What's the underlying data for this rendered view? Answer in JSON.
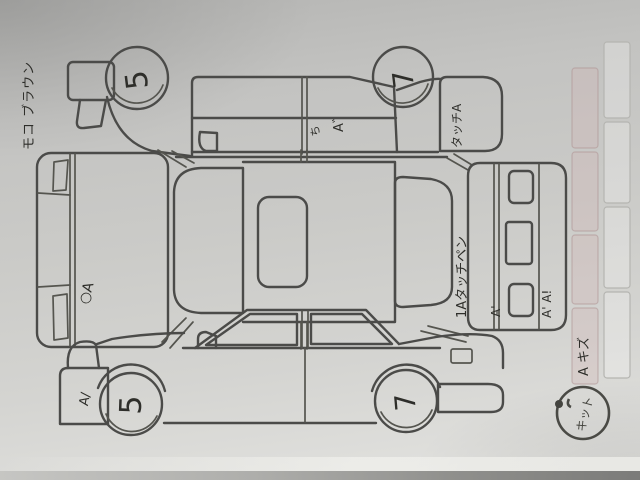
{
  "sheet": {
    "kind": "vehicle damage check sheet photo",
    "paper_color": "#cbcbc8",
    "line_color": "#4b4b49",
    "ink_color": "#2e2e2a",
    "stamp_color": "#44443f",
    "pink_cell_color": "#d2b2b2"
  },
  "note": {
    "text": "モコ ブラウン"
  },
  "top": {
    "wheel_front": "5",
    "wheel_rear": "7",
    "door_mark": "A゛",
    "door_scribble": "ち",
    "bumper_note": "タッチA"
  },
  "front": {
    "hood_mark": "○A"
  },
  "rear": {
    "glass_note": "1Aタッチペン",
    "bumper_mark": "A'",
    "corner_marks": "A' A!"
  },
  "bottom": {
    "wheel_front": "5",
    "wheel_rear": "7",
    "bumper_mark": "A/"
  },
  "side_note": {
    "text": "A キズ"
  },
  "stamp": {
    "text": "キット"
  }
}
